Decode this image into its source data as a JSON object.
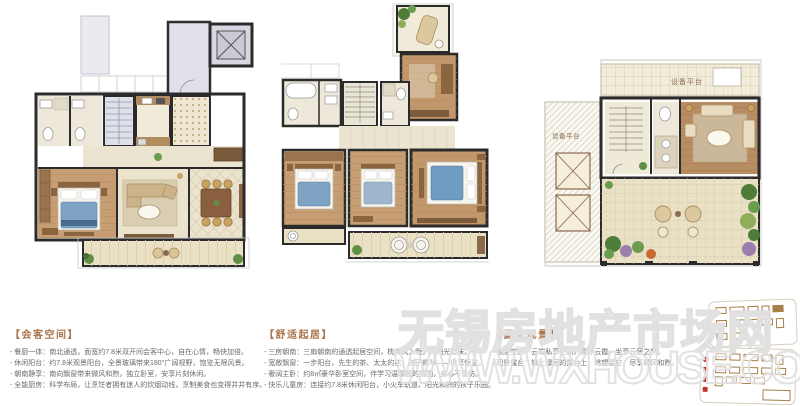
{
  "sections": [
    {
      "heading": "【会客空间】",
      "lines": [
        "- 餐厨一体：南北通透，面宽约7.8米双开间会客中心，自在心情，畅快加倍。",
        "- 休闲阳台：约7.8米观景阳台，全景玻璃带来180°广阔视野，饱览无限风景。",
        "- 朝南静享：南向飘窗带来微风和煦，独立卧室，安享片刻休闲。",
        "- 全能厨房：科学布局，让烹饪者拥有迷人的炊烟动线，烹制美食也变得井井有序。"
      ]
    },
    {
      "heading": "【舒适起居】",
      "lines": [
        "- 三房朝南：三扇朝南的通透起居空间，枕清风入眠，伴阳光起床。",
        "- 宽敞飘窗：一步阳台，先生的茶、太太的花、孩子的琴——俱享惬意。",
        "- 奢阔主卧：约8㎡豪华卧室空间，伴学习温馨般的氛围，身心不设防。",
        "- 快乐儿童房：连接约7.8米休闲阳台，小火车轨道、阳光和煦的孩子乐园。"
      ]
    },
    {
      "heading": "【露天观景】",
      "lines": [
        "- 顶层空间：云端私享空间，晨沐云霞，坐享云居之梦。",
        "- 观景露台：铺上绿茵的露台上，眺望星空，尽享微风和煦。"
      ]
    }
  ],
  "plans": {
    "roof": {
      "platform_top": "设备平台",
      "platform_left": "设备平台"
    }
  },
  "watermark": {
    "cn": "无锡房地产市场网",
    "url": "WWW.WXHOUSE.COM"
  },
  "colors": {
    "wall": "#2b2b2b",
    "wood": "#c79e73",
    "wood_dark": "#9a7450",
    "cream": "#ece4cf",
    "lavender": "#dcdee9",
    "bed_blue": "#7fa3c4",
    "plant_green": "#5f8f45",
    "heading": "#a9744c",
    "body_text": "#6b6b6b",
    "watermark_stroke": "#dfdfdf",
    "thumb_brown": "#a97f4a",
    "marker_red": "#c0392b"
  }
}
